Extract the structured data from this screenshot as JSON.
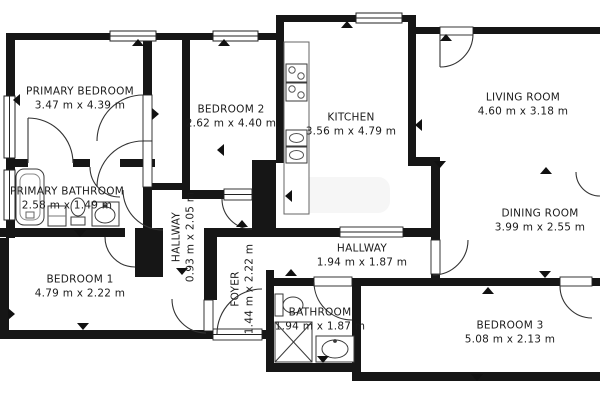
{
  "floorplan": {
    "title": "Apartment floor plan",
    "units": "m",
    "wall_color": "#161616",
    "line_color": "#333333",
    "rooms": [
      {
        "key": "primary-bedroom",
        "name": "PRIMARY BEDROOM",
        "dims": "3.47 m x 4.39 m",
        "width_m": 3.47,
        "depth_m": 4.39,
        "cx": 80,
        "cy": 99,
        "rot": 0
      },
      {
        "key": "bedroom-2",
        "name": "BEDROOM 2",
        "dims": "2.62 m x 4.40 m",
        "width_m": 2.62,
        "depth_m": 4.4,
        "cx": 231,
        "cy": 117,
        "rot": 0
      },
      {
        "key": "kitchen",
        "name": "KITCHEN",
        "dims": "3.56 m x 4.79 m",
        "width_m": 3.56,
        "depth_m": 4.79,
        "cx": 351,
        "cy": 125,
        "rot": 0
      },
      {
        "key": "living-room",
        "name": "LIVING ROOM",
        "dims": "4.60 m x 3.18 m",
        "width_m": 4.6,
        "depth_m": 3.18,
        "cx": 523,
        "cy": 105,
        "rot": 0
      },
      {
        "key": "primary-bathroom",
        "name": "PRIMARY BATHROOM",
        "dims": "2.58 m x 1.49 m",
        "width_m": 2.58,
        "depth_m": 1.49,
        "cx": 67,
        "cy": 199,
        "rot": 0
      },
      {
        "key": "hallway-west",
        "name": "HALLWAY",
        "dims": "0.93 m x 2.05 m",
        "width_m": 0.93,
        "depth_m": 2.05,
        "cx": 184,
        "cy": 237,
        "rot": -90
      },
      {
        "key": "foyer",
        "name": "FOYER",
        "dims": "1.44 m x 2.22 m",
        "width_m": 1.44,
        "depth_m": 2.22,
        "cx": 243,
        "cy": 289,
        "rot": -90
      },
      {
        "key": "hallway-center",
        "name": "HALLWAY",
        "dims": "1.94 m x 1.87 m",
        "width_m": 1.94,
        "depth_m": 1.87,
        "cx": 362,
        "cy": 256,
        "rot": 0
      },
      {
        "key": "dining-room",
        "name": "DINING ROOM",
        "dims": "3.99 m x 2.55 m",
        "width_m": 3.99,
        "depth_m": 2.55,
        "cx": 540,
        "cy": 221,
        "rot": 0
      },
      {
        "key": "bathroom",
        "name": "BATHROOM",
        "dims": "1.94 m x 1.87 m",
        "width_m": 1.94,
        "depth_m": 1.87,
        "cx": 320,
        "cy": 320,
        "rot": 0
      },
      {
        "key": "bedroom-1",
        "name": "BEDROOM 1",
        "dims": "4.79 m x 2.22 m",
        "width_m": 4.79,
        "depth_m": 2.22,
        "cx": 80,
        "cy": 287,
        "rot": 0
      },
      {
        "key": "bedroom-3",
        "name": "BEDROOM 3",
        "dims": "5.08 m x 2.13 m",
        "width_m": 5.08,
        "depth_m": 2.13,
        "cx": 510,
        "cy": 333,
        "rot": 0
      }
    ],
    "fixtures": [
      "bathtub-icon",
      "toilet-icon",
      "sink-icon",
      "shower-icon",
      "stove-icon",
      "kitchen-sink-icon",
      "kitchen-counter",
      "closet-doors",
      "window-symbol",
      "door-swing-arc",
      "direction-marker"
    ]
  }
}
